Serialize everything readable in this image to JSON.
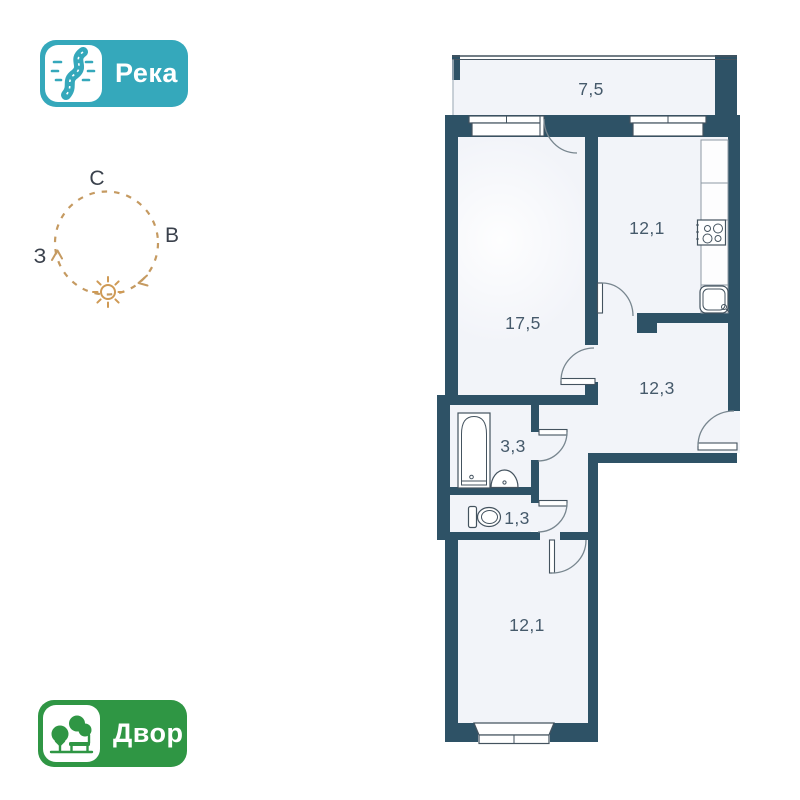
{
  "badges": {
    "river": {
      "label": "Река",
      "color": "#35a8bb",
      "icon": "river-icon"
    },
    "yard": {
      "label": "Двор",
      "color": "#2f9644",
      "icon": "park-icon"
    }
  },
  "compass": {
    "north": "С",
    "east": "В",
    "west": "З",
    "circle_color": "#c59a61",
    "sun_color": "#cf9a55",
    "letter_color": "#3a414c"
  },
  "plan": {
    "wall_color": "#2e5266",
    "floor_color": "#f2f4f9",
    "label_color": "#465a6b",
    "rooms": [
      {
        "id": "balcony",
        "area": "7,5"
      },
      {
        "id": "living-room",
        "area": "17,5"
      },
      {
        "id": "kitchen",
        "area": "12,1"
      },
      {
        "id": "hallway",
        "area": "12,3"
      },
      {
        "id": "bathroom",
        "area": "3,3"
      },
      {
        "id": "wc",
        "area": "1,3"
      },
      {
        "id": "bedroom",
        "area": "12,1"
      }
    ]
  }
}
